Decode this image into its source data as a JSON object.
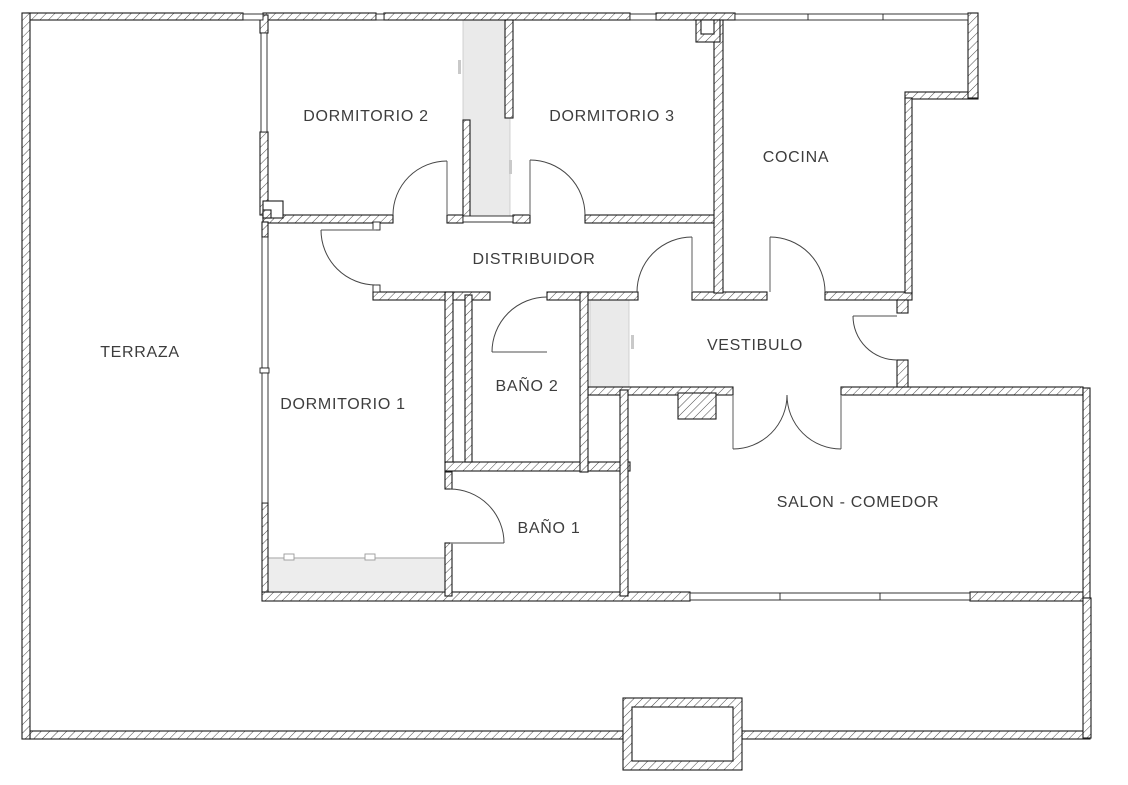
{
  "plan": {
    "type": "apartment-floor-plan",
    "rooms": {
      "terraza": {
        "label": "TERRAZA"
      },
      "dormitorio2": {
        "label": "DORMITORIO 2"
      },
      "dormitorio3": {
        "label": "DORMITORIO 3"
      },
      "cocina": {
        "label": "COCINA"
      },
      "distribuidor": {
        "label": "DISTRIBUIDOR"
      },
      "vestibulo": {
        "label": "VESTIBULO"
      },
      "dormitorio1": {
        "label": "DORMITORIO 1"
      },
      "bano2": {
        "label": "BAÑO 2"
      },
      "bano1": {
        "label": "BAÑO 1"
      },
      "salon": {
        "label": "SALON - COMEDOR"
      }
    },
    "colors": {
      "wall_outline": "#1b1b1b",
      "wall_hatch": "#4a4a4a",
      "label_text": "#3d3d3d",
      "shaft_fill": "#eaeaea",
      "wardrobe_fill": "#ededed",
      "background": "#ffffff"
    }
  }
}
